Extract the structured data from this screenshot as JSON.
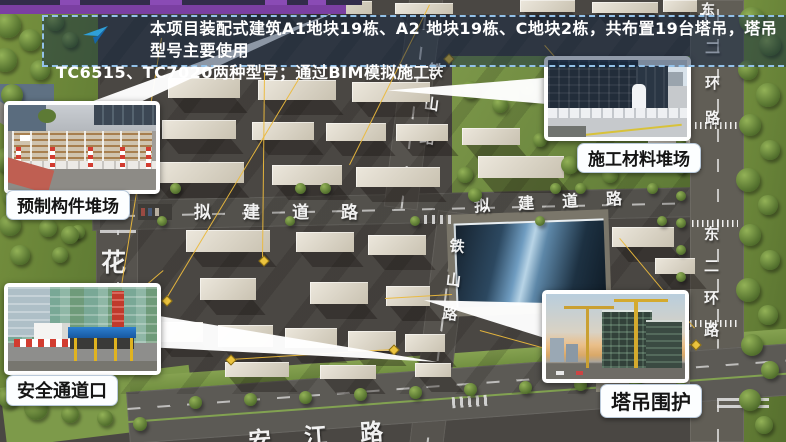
{
  "banner": {
    "line1": "本项目装配式建筑A1地块19栋、A2 地块19栋、C地块2栋，共布置19台塔吊，塔吊型号主要使用",
    "line2": "TC6515、TC7020两种型号；通过BIM模拟施工。",
    "icon": "paper-plane-icon"
  },
  "callouts": {
    "precast": {
      "label": "预制构件堆场"
    },
    "materials": {
      "label": "施工材料堆场"
    },
    "safety": {
      "label": "安全通道口"
    },
    "crane_fence": {
      "label": "塔吊围护"
    }
  },
  "road_labels": {
    "planned_road_west": "拟建道路",
    "planned_road_east": "拟建道路",
    "tieshan_north": "铁山路",
    "tieshan_south": "铁山路",
    "ring_road_north": "二环路",
    "ring_road_north_partial": "东",
    "ring_road_east": "东二环路",
    "hua": "花",
    "south_road": "安江路"
  },
  "colors": {
    "accent_purple": "#7b3fa2",
    "banner_border": "#93c1e8",
    "banner_text": "#ffffff",
    "crane_line_yellow": "#ecc43e",
    "label_text": "#151515"
  }
}
